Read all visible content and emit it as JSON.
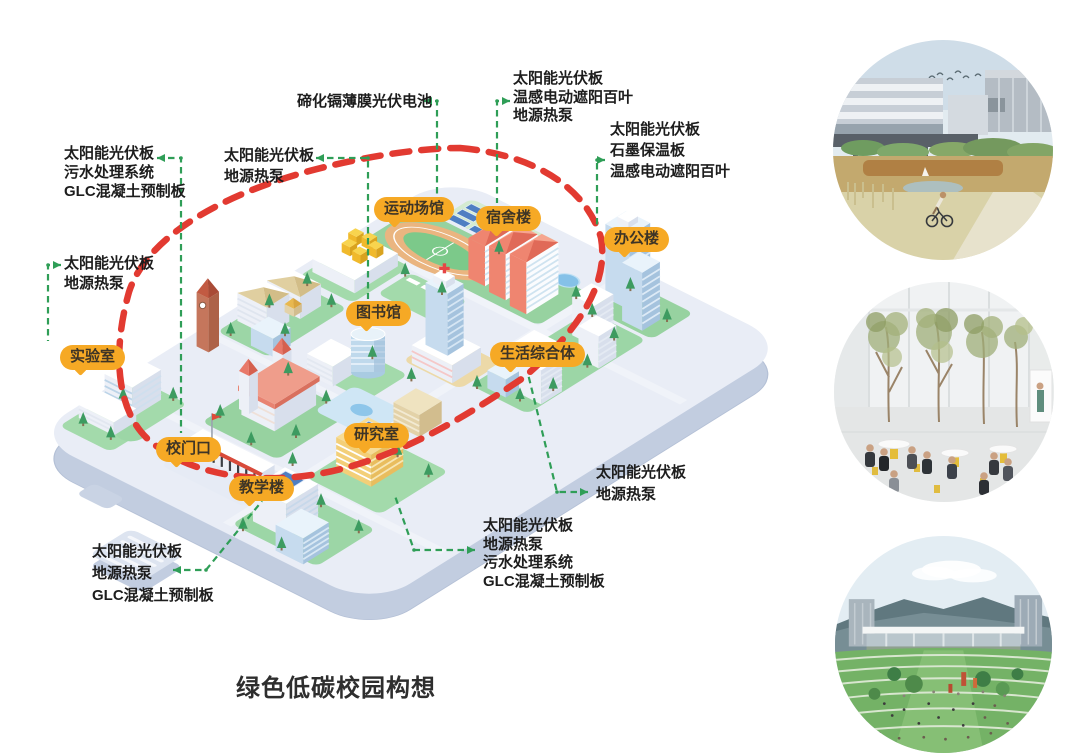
{
  "title": "绿色低碳校园构想",
  "buildings": [
    {
      "label": "运动场馆"
    },
    {
      "label": "宿舍楼"
    },
    {
      "label": "办公楼"
    },
    {
      "label": "图书馆"
    },
    {
      "label": "生活综合体"
    },
    {
      "label": "实验室"
    },
    {
      "label": "校门口"
    },
    {
      "label": "教学楼"
    },
    {
      "label": "研究室"
    }
  ],
  "annotations": {
    "top_center": {
      "lines": [
        "碲化镉薄膜光伏电池"
      ]
    },
    "top_right": {
      "lines": [
        "太阳能光伏板",
        "温感电动遮阳百叶",
        "地源热泵"
      ]
    },
    "right_upper": {
      "lines": [
        "太阳能光伏板",
        "石墨保温板",
        "温感电动遮阳百叶"
      ]
    },
    "mid_upper": {
      "lines": [
        "太阳能光伏板",
        "地源热泵"
      ]
    },
    "left_upper": {
      "lines": [
        "太阳能光伏板",
        "污水处理系统",
        "GLC混凝土预制板"
      ]
    },
    "left_mid": {
      "lines": [
        "太阳能光伏板",
        "地源热泵"
      ]
    },
    "bottom_left": {
      "lines": [
        "太阳能光伏板",
        "地源热泵",
        "GLC混凝土预制板"
      ]
    },
    "bottom_center": {
      "lines": [
        "太阳能光伏板",
        "地源热泵",
        "污水处理系统",
        "GLC混凝土预制板"
      ]
    },
    "mid_right": {
      "lines": [
        "太阳能光伏板",
        "地源热泵"
      ]
    }
  },
  "colors": {
    "label_bg": "#f6a925",
    "label_text": "#3d3426",
    "annotation_green": "#2f9e57",
    "boundary_red": "#e23a31",
    "title_text": "#2e2e2e"
  }
}
